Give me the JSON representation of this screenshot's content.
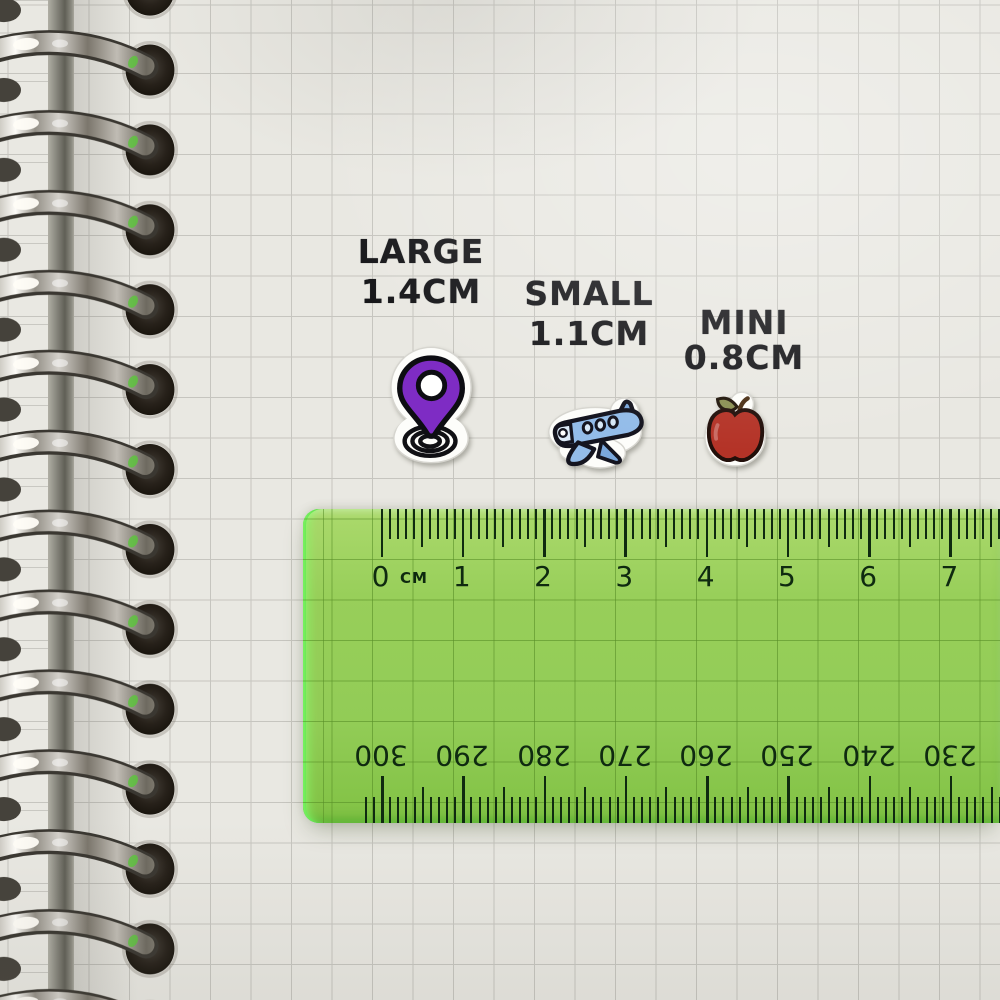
{
  "stickers": [
    {
      "icon": "location-pin-sticker",
      "size_label": "LARGE",
      "size_value": "1.4CM",
      "pin_color": "#7e2cc4",
      "outline_color": "#121216",
      "die_cut_color": "#fdfdfa"
    },
    {
      "icon": "airplane-sticker",
      "size_label": "SMALL",
      "size_value": "1.1CM",
      "plane_color": "#93bce9",
      "plane_shade_color": "#7aa7dc",
      "outline_color": "#14141f",
      "die_cut_color": "#fdfdfa"
    },
    {
      "icon": "apple-sticker",
      "size_label": "MINI",
      "size_value": "0.8CM",
      "apple_color": "#b43327",
      "leaf_color": "#8a8f52",
      "outline_color": "#241109",
      "die_cut_color": "#fdfdfa"
    }
  ],
  "ruler": {
    "unit_label": "CM",
    "top_scale_numbers": [
      "0",
      "1",
      "2",
      "3",
      "4",
      "5",
      "6",
      "7"
    ],
    "bottom_scale_numbers": [
      "300",
      "290",
      "280",
      "270",
      "260",
      "250",
      "240",
      "230"
    ],
    "body_color": "#8cc94d",
    "edge_color": "#3ecd37",
    "marking_color": "#0f2a10"
  },
  "notebook": {
    "paper_color": "#e9e8e2",
    "grid_color": "#c6c5bf",
    "visible_rings": 12,
    "ring_metal_color": "#b5b1a9",
    "hole_color": "#1a160f"
  }
}
